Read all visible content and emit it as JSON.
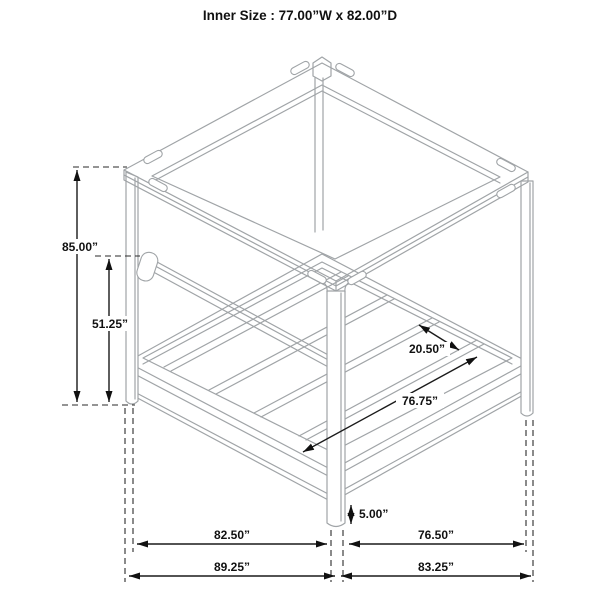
{
  "title": "Inner Size : 77.00”W x 82.00”D",
  "dimensions": {
    "overall_height": "85.00”",
    "rail_height": "51.25”",
    "slat_spacing": "20.50”",
    "inner_platform_depth": "76.75”",
    "bottom_clearance": "5.00”",
    "post_span_width": "82.50”",
    "post_span_depth": "76.50”",
    "overall_width": "89.25”",
    "overall_depth": "83.25”"
  },
  "colors": {
    "frame_line": "#a0a4a7",
    "dimension_line": "#1a1a1a",
    "background": "#ffffff"
  }
}
